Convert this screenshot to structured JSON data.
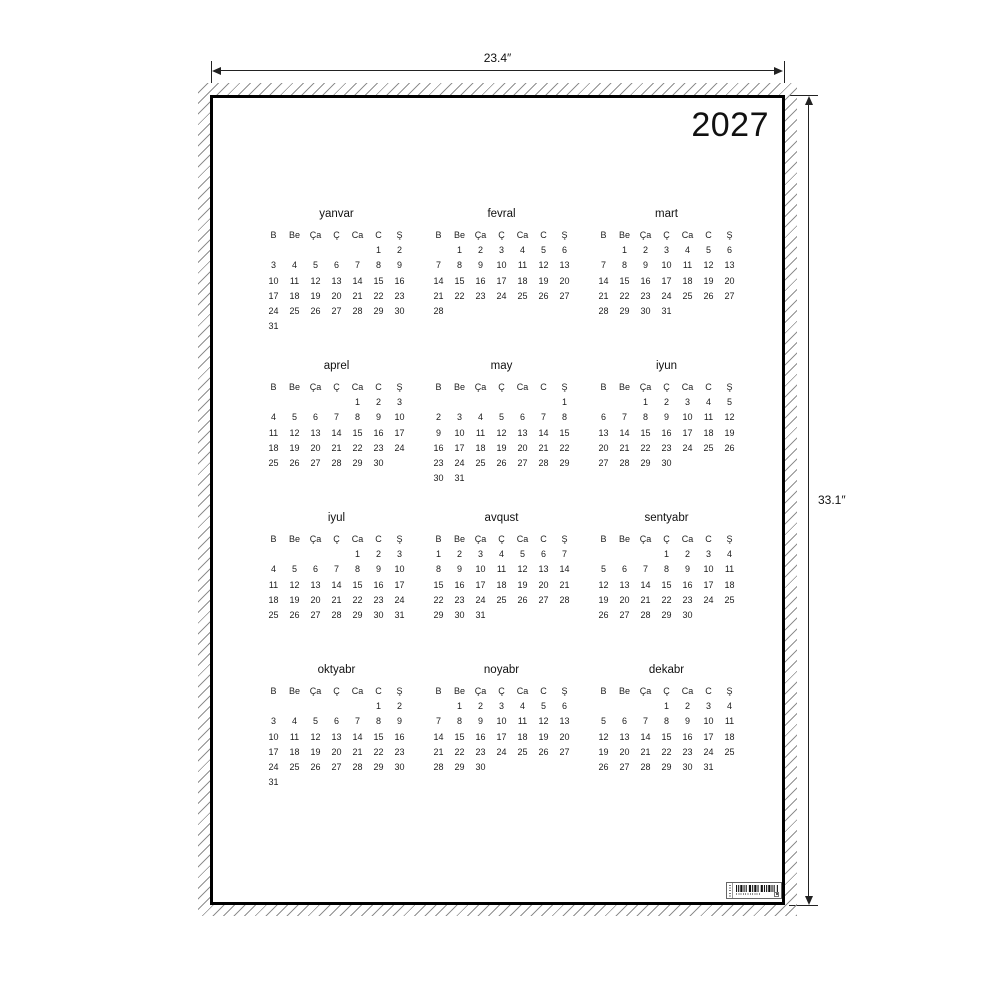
{
  "poster": {
    "year": "2027"
  },
  "dimensions": {
    "width_label": "23.4″",
    "height_label": "33.1″"
  },
  "calendar": {
    "weekdays": [
      "B",
      "Be",
      "Ça",
      "Ç",
      "Ca",
      "C",
      "Ş"
    ],
    "months": [
      {
        "name": "yanvar",
        "weeks": [
          [
            "",
            "",
            "",
            "",
            "",
            "1",
            "2"
          ],
          [
            "3",
            "4",
            "5",
            "6",
            "7",
            "8",
            "9"
          ],
          [
            "10",
            "11",
            "12",
            "13",
            "14",
            "15",
            "16"
          ],
          [
            "17",
            "18",
            "19",
            "20",
            "21",
            "22",
            "23"
          ],
          [
            "24",
            "25",
            "26",
            "27",
            "28",
            "29",
            "30"
          ],
          [
            "31",
            "",
            "",
            "",
            "",
            "",
            ""
          ]
        ]
      },
      {
        "name": "fevral",
        "weeks": [
          [
            "",
            "1",
            "2",
            "3",
            "4",
            "5",
            "6"
          ],
          [
            "7",
            "8",
            "9",
            "10",
            "11",
            "12",
            "13"
          ],
          [
            "14",
            "15",
            "16",
            "17",
            "18",
            "19",
            "20"
          ],
          [
            "21",
            "22",
            "23",
            "24",
            "25",
            "26",
            "27"
          ],
          [
            "28",
            "",
            "",
            "",
            "",
            "",
            ""
          ]
        ]
      },
      {
        "name": "mart",
        "weeks": [
          [
            "",
            "1",
            "2",
            "3",
            "4",
            "5",
            "6"
          ],
          [
            "7",
            "8",
            "9",
            "10",
            "11",
            "12",
            "13"
          ],
          [
            "14",
            "15",
            "16",
            "17",
            "18",
            "19",
            "20"
          ],
          [
            "21",
            "22",
            "23",
            "24",
            "25",
            "26",
            "27"
          ],
          [
            "28",
            "29",
            "30",
            "31",
            "",
            "",
            ""
          ]
        ]
      },
      {
        "name": "aprel",
        "weeks": [
          [
            "",
            "",
            "",
            "",
            "1",
            "2",
            "3"
          ],
          [
            "4",
            "5",
            "6",
            "7",
            "8",
            "9",
            "10"
          ],
          [
            "11",
            "12",
            "13",
            "14",
            "15",
            "16",
            "17"
          ],
          [
            "18",
            "19",
            "20",
            "21",
            "22",
            "23",
            "24"
          ],
          [
            "25",
            "26",
            "27",
            "28",
            "29",
            "30",
            ""
          ]
        ]
      },
      {
        "name": "may",
        "weeks": [
          [
            "",
            "",
            "",
            "",
            "",
            "",
            "1"
          ],
          [
            "2",
            "3",
            "4",
            "5",
            "6",
            "7",
            "8"
          ],
          [
            "9",
            "10",
            "11",
            "12",
            "13",
            "14",
            "15"
          ],
          [
            "16",
            "17",
            "18",
            "19",
            "20",
            "21",
            "22"
          ],
          [
            "23",
            "24",
            "25",
            "26",
            "27",
            "28",
            "29"
          ],
          [
            "30",
            "31",
            "",
            "",
            "",
            "",
            ""
          ]
        ]
      },
      {
        "name": "iyun",
        "weeks": [
          [
            "",
            "",
            "1",
            "2",
            "3",
            "4",
            "5"
          ],
          [
            "6",
            "7",
            "8",
            "9",
            "10",
            "11",
            "12"
          ],
          [
            "13",
            "14",
            "15",
            "16",
            "17",
            "18",
            "19"
          ],
          [
            "20",
            "21",
            "22",
            "23",
            "24",
            "25",
            "26"
          ],
          [
            "27",
            "28",
            "29",
            "30",
            "",
            "",
            ""
          ]
        ]
      },
      {
        "name": "iyul",
        "weeks": [
          [
            "",
            "",
            "",
            "",
            "1",
            "2",
            "3"
          ],
          [
            "4",
            "5",
            "6",
            "7",
            "8",
            "9",
            "10"
          ],
          [
            "11",
            "12",
            "13",
            "14",
            "15",
            "16",
            "17"
          ],
          [
            "18",
            "19",
            "20",
            "21",
            "22",
            "23",
            "24"
          ],
          [
            "25",
            "26",
            "27",
            "28",
            "29",
            "30",
            "31"
          ]
        ]
      },
      {
        "name": "avqust",
        "weeks": [
          [
            "1",
            "2",
            "3",
            "4",
            "5",
            "6",
            "7"
          ],
          [
            "8",
            "9",
            "10",
            "11",
            "12",
            "13",
            "14"
          ],
          [
            "15",
            "16",
            "17",
            "18",
            "19",
            "20",
            "21"
          ],
          [
            "22",
            "23",
            "24",
            "25",
            "26",
            "27",
            "28"
          ],
          [
            "29",
            "30",
            "31",
            "",
            "",
            "",
            ""
          ]
        ]
      },
      {
        "name": "sentyabr",
        "weeks": [
          [
            "",
            "",
            "",
            "1",
            "2",
            "3",
            "4"
          ],
          [
            "5",
            "6",
            "7",
            "8",
            "9",
            "10",
            "11"
          ],
          [
            "12",
            "13",
            "14",
            "15",
            "16",
            "17",
            "18"
          ],
          [
            "19",
            "20",
            "21",
            "22",
            "23",
            "24",
            "25"
          ],
          [
            "26",
            "27",
            "28",
            "29",
            "30",
            "",
            ""
          ]
        ]
      },
      {
        "name": "oktyabr",
        "weeks": [
          [
            "",
            "",
            "",
            "",
            "",
            "1",
            "2"
          ],
          [
            "3",
            "4",
            "5",
            "6",
            "7",
            "8",
            "9"
          ],
          [
            "10",
            "11",
            "12",
            "13",
            "14",
            "15",
            "16"
          ],
          [
            "17",
            "18",
            "19",
            "20",
            "21",
            "22",
            "23"
          ],
          [
            "24",
            "25",
            "26",
            "27",
            "28",
            "29",
            "30"
          ],
          [
            "31",
            "",
            "",
            "",
            "",
            "",
            ""
          ]
        ]
      },
      {
        "name": "noyabr",
        "weeks": [
          [
            "",
            "1",
            "2",
            "3",
            "4",
            "5",
            "6"
          ],
          [
            "7",
            "8",
            "9",
            "10",
            "11",
            "12",
            "13"
          ],
          [
            "14",
            "15",
            "16",
            "17",
            "18",
            "19",
            "20"
          ],
          [
            "21",
            "22",
            "23",
            "24",
            "25",
            "26",
            "27"
          ],
          [
            "28",
            "29",
            "30",
            "",
            "",
            "",
            ""
          ]
        ]
      },
      {
        "name": "dekabr",
        "weeks": [
          [
            "",
            "",
            "",
            "1",
            "2",
            "3",
            "4"
          ],
          [
            "5",
            "6",
            "7",
            "8",
            "9",
            "10",
            "11"
          ],
          [
            "12",
            "13",
            "14",
            "15",
            "16",
            "17",
            "18"
          ],
          [
            "19",
            "20",
            "21",
            "22",
            "23",
            "24",
            "25"
          ],
          [
            "26",
            "27",
            "28",
            "29",
            "30",
            "31",
            ""
          ]
        ]
      }
    ]
  }
}
